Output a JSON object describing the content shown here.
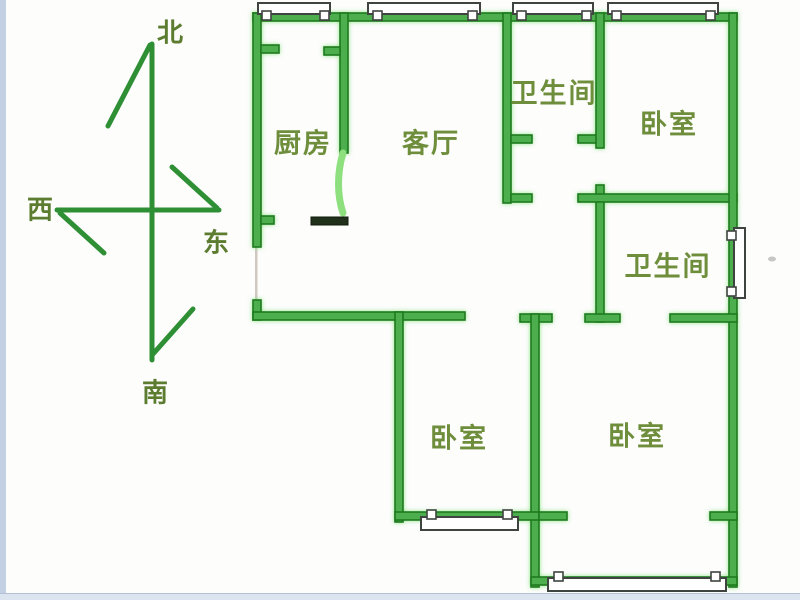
{
  "diagram": {
    "type": "apartment-floor-plan",
    "rooms": [
      {
        "id": "kitchen",
        "label": "厨房"
      },
      {
        "id": "living-room",
        "label": "客厅"
      },
      {
        "id": "bathroom-top",
        "label": "卫生间"
      },
      {
        "id": "bedroom-top-right",
        "label": "卧室"
      },
      {
        "id": "bathroom-right",
        "label": "卫生间"
      },
      {
        "id": "bedroom-bottom-middle",
        "label": "卧室"
      },
      {
        "id": "bedroom-bottom-right",
        "label": "卧室"
      }
    ],
    "compass": {
      "north": "北",
      "south": "南",
      "east": "东",
      "west": "西"
    }
  },
  "colors": {
    "background": "#fdfdfc",
    "wall_fill": "#4cae4c",
    "wall_border": "#1e7a1e",
    "door_leaf": "#8ee07f",
    "dark_segment": "#20301a",
    "window_border": "#3f4440",
    "room_label": "#6e8e3c",
    "compass_label": "#5c7c30",
    "compass_line": "#2e8f34",
    "edge_stripe": "#c3cfe2",
    "bottom_stripe": "#dce4f0"
  }
}
